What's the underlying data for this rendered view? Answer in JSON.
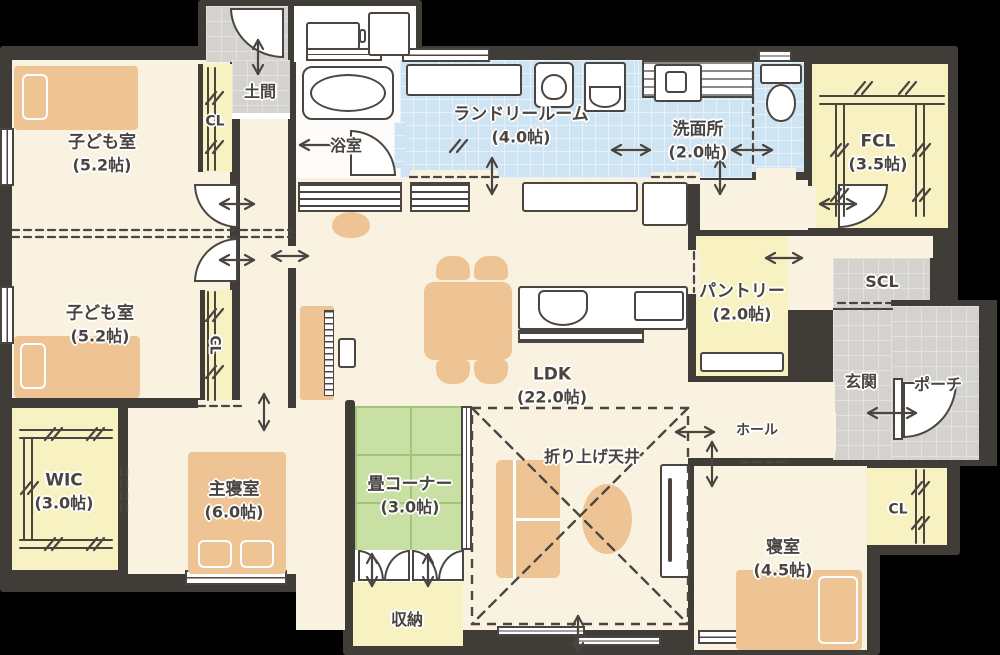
{
  "plan_type": "japanese-floorplan",
  "colors": {
    "wall": "#403c38",
    "floor": "#f9f2e1",
    "closet": "#f8f2c3",
    "tatami": "#c9e0a4",
    "wet_area": "#cfe4f2",
    "tile": "#d3d2cf",
    "furniture": "#eec494",
    "label_text": "#494440",
    "background": "#000000"
  },
  "rooms": {
    "kids1": {
      "name": "子ども室",
      "size": "(5.2帖)"
    },
    "kids2": {
      "name": "子ども室",
      "size": "(5.2帖)"
    },
    "cl1": {
      "name": "CL"
    },
    "cl2": {
      "name": "CL"
    },
    "cl3": {
      "name": "CL"
    },
    "doma": {
      "name": "土間"
    },
    "bath": {
      "name": "浴室"
    },
    "laundry": {
      "name": "ランドリールーム",
      "size": "(4.0帖)"
    },
    "senmen": {
      "name": "洗面所",
      "size": "(2.0帖)"
    },
    "fcl": {
      "name": "FCL",
      "size": "(3.5帖)"
    },
    "scl": {
      "name": "SCL"
    },
    "pantry": {
      "name": "パントリー",
      "size": "(2.0帖)"
    },
    "genkan": {
      "name": "玄関"
    },
    "porch": {
      "name": "ポーチ"
    },
    "ldk": {
      "name": "LDK",
      "size": "(22.0帖)"
    },
    "ceiling": {
      "name": "折り上げ天井"
    },
    "hall": {
      "name": "ホール"
    },
    "tatami": {
      "name": "畳コーナー",
      "size": "(3.0帖)"
    },
    "storage": {
      "name": "収納"
    },
    "wic": {
      "name": "WIC",
      "size": "(3.0帖)"
    },
    "master": {
      "name": "主寝室",
      "size": "(6.0帖)"
    },
    "bedroom": {
      "name": "寝室",
      "size": "(4.5帖)"
    }
  }
}
